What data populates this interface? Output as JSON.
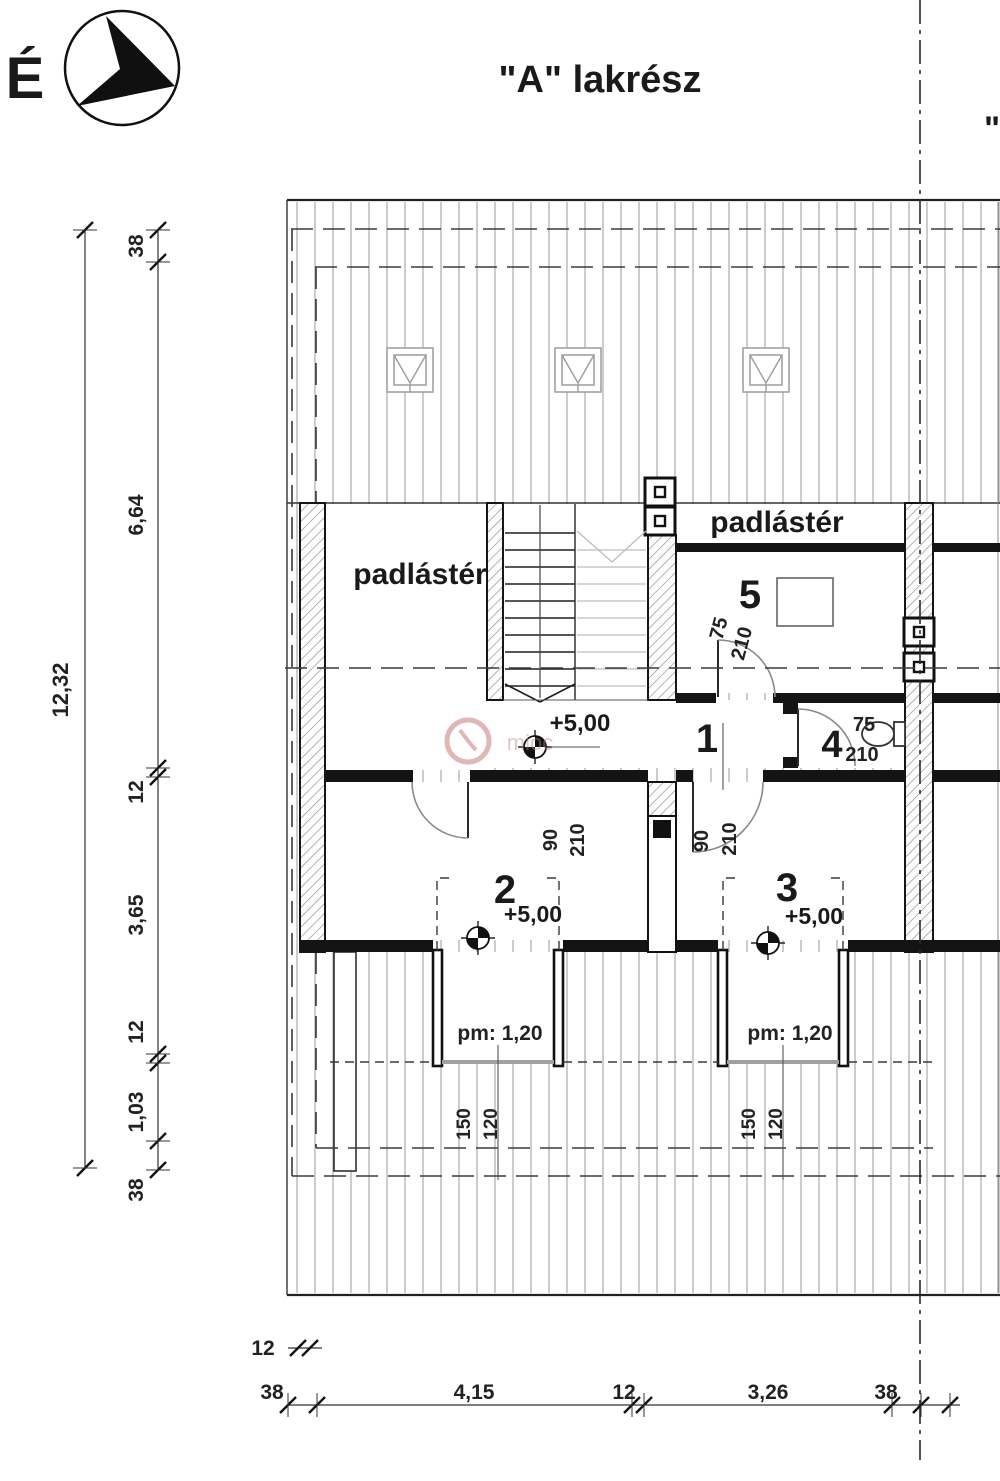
{
  "header": {
    "north_label": "É",
    "title": "\"A\" lakrész",
    "section_b_hint": "\""
  },
  "areas": {
    "attic_left_label": "padlástér",
    "attic_right_label": "padlástér",
    "room1_number": "1",
    "room1_level": "+5,00",
    "room2_number": "2",
    "room2_level": "+5,00",
    "room2_sill_height": "pm: 1,20",
    "room3_number": "3",
    "room3_level": "+5,00",
    "room3_sill_height": "pm: 1,20",
    "room4_number": "4",
    "room5_number": "5"
  },
  "doors": {
    "attic_to_room2": {
      "width": "90",
      "height": "210"
    },
    "hall_to_room3": {
      "width": "90",
      "height": "210"
    },
    "room5_door": {
      "width": "75",
      "height": "210"
    },
    "wc_door": {
      "width": "75",
      "height": "210"
    }
  },
  "windows": {
    "room2_window": {
      "width": "150",
      "height": "120"
    },
    "room3_window": {
      "width": "150",
      "height": "120"
    }
  },
  "dimensions": {
    "left_total": "12,32",
    "left_chain": [
      "38",
      "6,64",
      "12",
      "3,65",
      "12",
      "1,03",
      "38"
    ],
    "bottom_chain": [
      "38",
      "4,15",
      "12",
      "3,26",
      "38"
    ],
    "bottom_eave_offset": "12"
  },
  "watermark_text": "mioc",
  "colors": {
    "line": "#1a1a1a",
    "roof_line": "#999999",
    "watermark": "#c0605f"
  }
}
